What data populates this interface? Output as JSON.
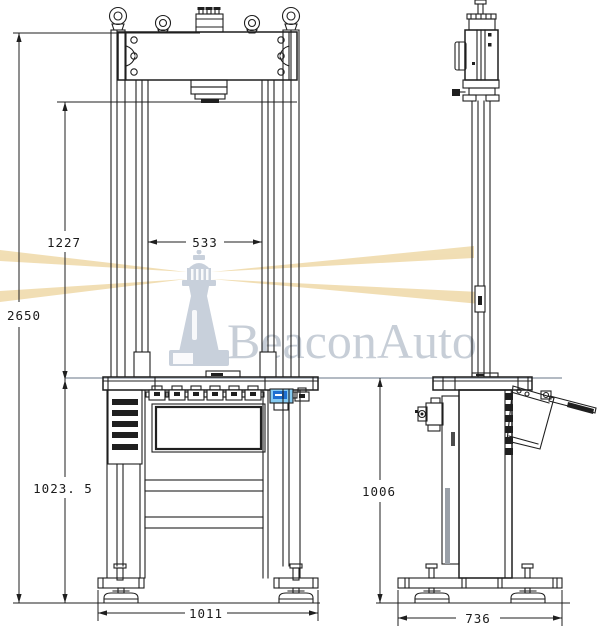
{
  "drawing": {
    "type": "engineering-two-view",
    "subject": "hydraulic press testing machine outline drawing"
  },
  "watermark": {
    "brand": "BeaconAuto",
    "logo": "lighthouse-icon",
    "beam_color": "#eed7a2",
    "logo_color": "#c6ceda",
    "text_color": "#c1c9d3"
  },
  "front_view": {
    "label": "front-view",
    "dims": {
      "overall_height": "2650",
      "ram_to_table": "1227",
      "column_clear_width": "533",
      "table_to_ground": "1023. 5",
      "base_width": "1011"
    }
  },
  "side_view": {
    "label": "side-view",
    "dims": {
      "table_to_ground": "1006",
      "base_depth": "736"
    }
  },
  "colors": {
    "line": "#1f1f1f",
    "projection_line": "#b3bac3",
    "display_body": "#85cbf2",
    "display_screen": "#1e6fd0"
  }
}
